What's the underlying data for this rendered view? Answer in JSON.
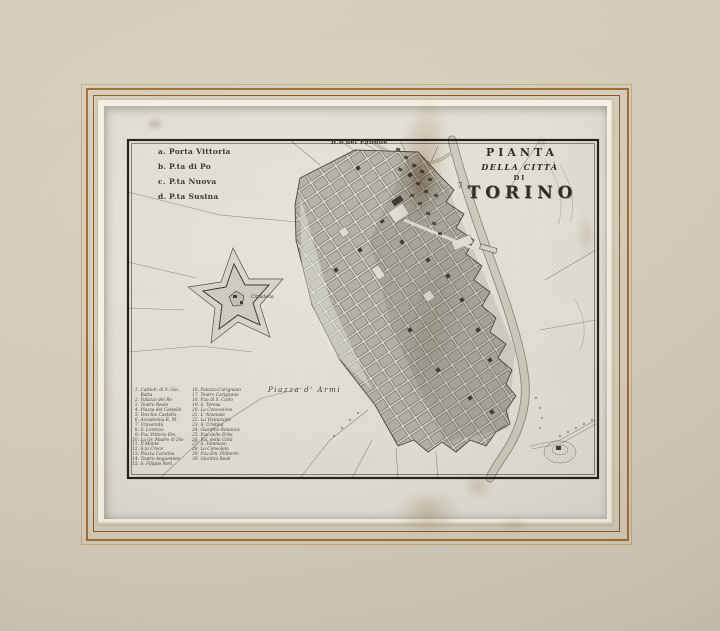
{
  "title_block": {
    "line1": "PIANTA",
    "line2": "DELLA CITTÀ",
    "line3": "DI",
    "line4": "TORINO"
  },
  "gates": [
    {
      "key": "a.",
      "label": "Porta Vittoria"
    },
    {
      "key": "b.",
      "label": "P.ta di Po"
    },
    {
      "key": "c.",
      "label": "P.ta Nuova"
    },
    {
      "key": "d.",
      "label": "P.ta Susina"
    }
  ],
  "map_labels": {
    "district": "B.o del Pallone",
    "citadel": "Cittadella",
    "parade_ground": "Piazza d' Armi",
    "river": "Po"
  },
  "index": {
    "left": [
      {
        "n": "1.",
        "label": "Cattedr. di S. Gio. Batta"
      },
      {
        "n": "2.",
        "label": "Palazzo del Re"
      },
      {
        "n": "3.",
        "label": "Teatro Reale"
      },
      {
        "n": "4.",
        "label": "Piazza del Castello"
      },
      {
        "n": "5.",
        "label": "Vecchio Castello"
      },
      {
        "n": "6.",
        "label": "Accademia R. M."
      },
      {
        "n": "7.",
        "label": "Università"
      },
      {
        "n": "8.",
        "label": "S. Lorenzo"
      },
      {
        "n": "9.",
        "label": "P.za Vittorio Em."
      },
      {
        "n": "10.",
        "label": "La Gr. Madre di Dio"
      },
      {
        "n": "11.",
        "label": "Il Monte"
      },
      {
        "n": "12.",
        "label": "S.ta Croce"
      },
      {
        "n": "13.",
        "label": "Piazza Carolina"
      },
      {
        "n": "14.",
        "label": "Teatro Anguennes"
      },
      {
        "n": "15.",
        "label": "S. Filippo Neri"
      }
    ],
    "right": [
      {
        "n": "16.",
        "label": "Palazzo Carignano"
      },
      {
        "n": "17.",
        "label": "Teatro Carignano"
      },
      {
        "n": "18.",
        "label": "P.za di S. Carlo"
      },
      {
        "n": "19.",
        "label": "S. Teresa"
      },
      {
        "n": "20.",
        "label": "La Concezione"
      },
      {
        "n": "21.",
        "label": "L' Arsenale"
      },
      {
        "n": "22.",
        "label": "La Visitazione"
      },
      {
        "n": "23.",
        "label": "S. Cristina"
      },
      {
        "n": "24.",
        "label": "Giardino Botanico"
      },
      {
        "n": "25.",
        "label": "P.za delle Erbe"
      },
      {
        "n": "26.",
        "label": "Pal. della Città"
      },
      {
        "n": "27.",
        "label": "S. Tommaso"
      },
      {
        "n": "28.",
        "label": "La Consolata"
      },
      {
        "n": "29.",
        "label": "P.za Em. Filiberto"
      },
      {
        "n": "30.",
        "label": "Giardini Reali"
      }
    ]
  },
  "colors": {
    "mat": "#d3cbb8",
    "mat_line_gold": "#a06e2e",
    "mat_line_brown": "#8a5c26",
    "paper": "#e6e3da",
    "ink": "#3a3831",
    "city_block": "#b4b2a8",
    "river": "#cdcabe",
    "stain": "#996c37"
  }
}
